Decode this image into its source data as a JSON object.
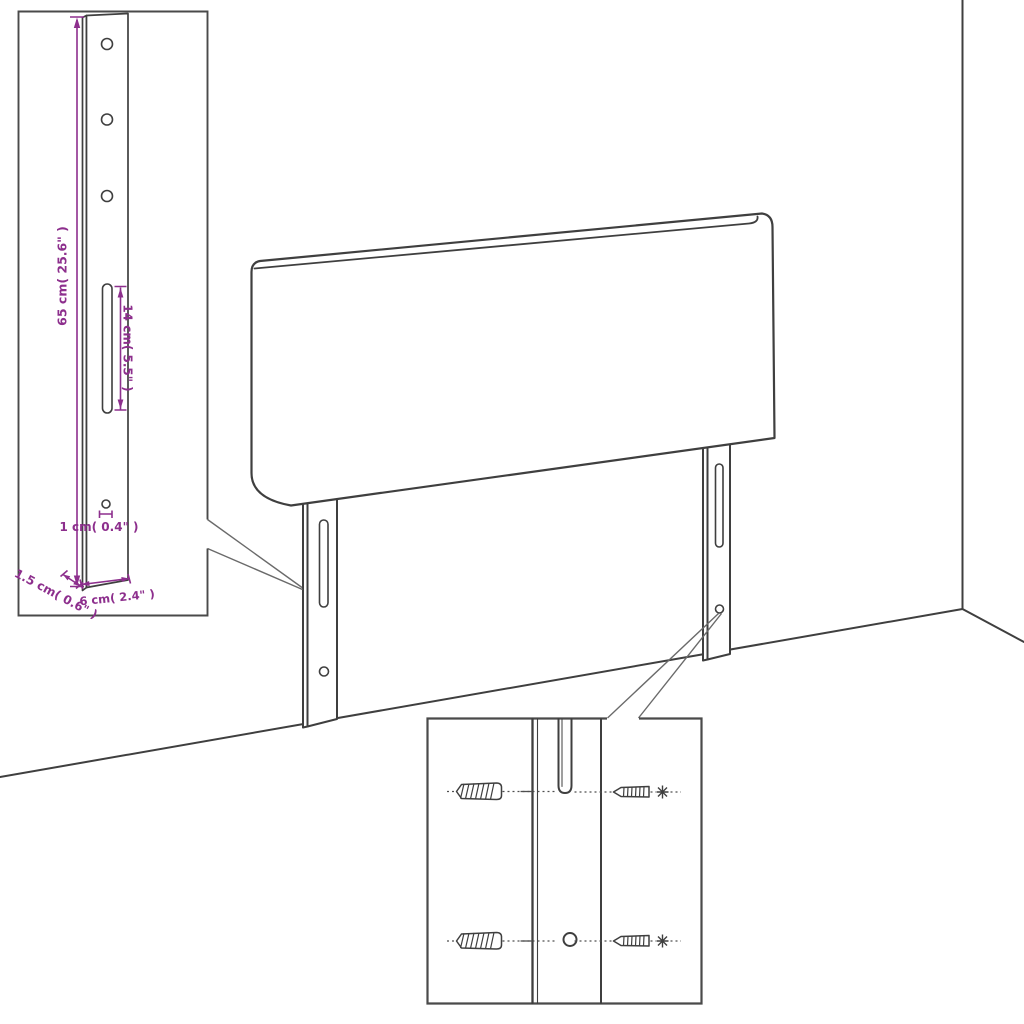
{
  "colors": {
    "outline": "#3f3f3f",
    "box_border": "#4a4a4a",
    "dimension": "#8d2f8d",
    "background": "#ffffff"
  },
  "insets": {
    "leg_detail": {
      "dimensions": {
        "height": "65 cm( 25.6\" )",
        "slot": "14 cm( 5.5\" )",
        "hole": "1 cm( 0.4\" )",
        "depth": "1.5 cm( 0.6\" )",
        "width": "6 cm( 2.4\" )"
      }
    }
  }
}
